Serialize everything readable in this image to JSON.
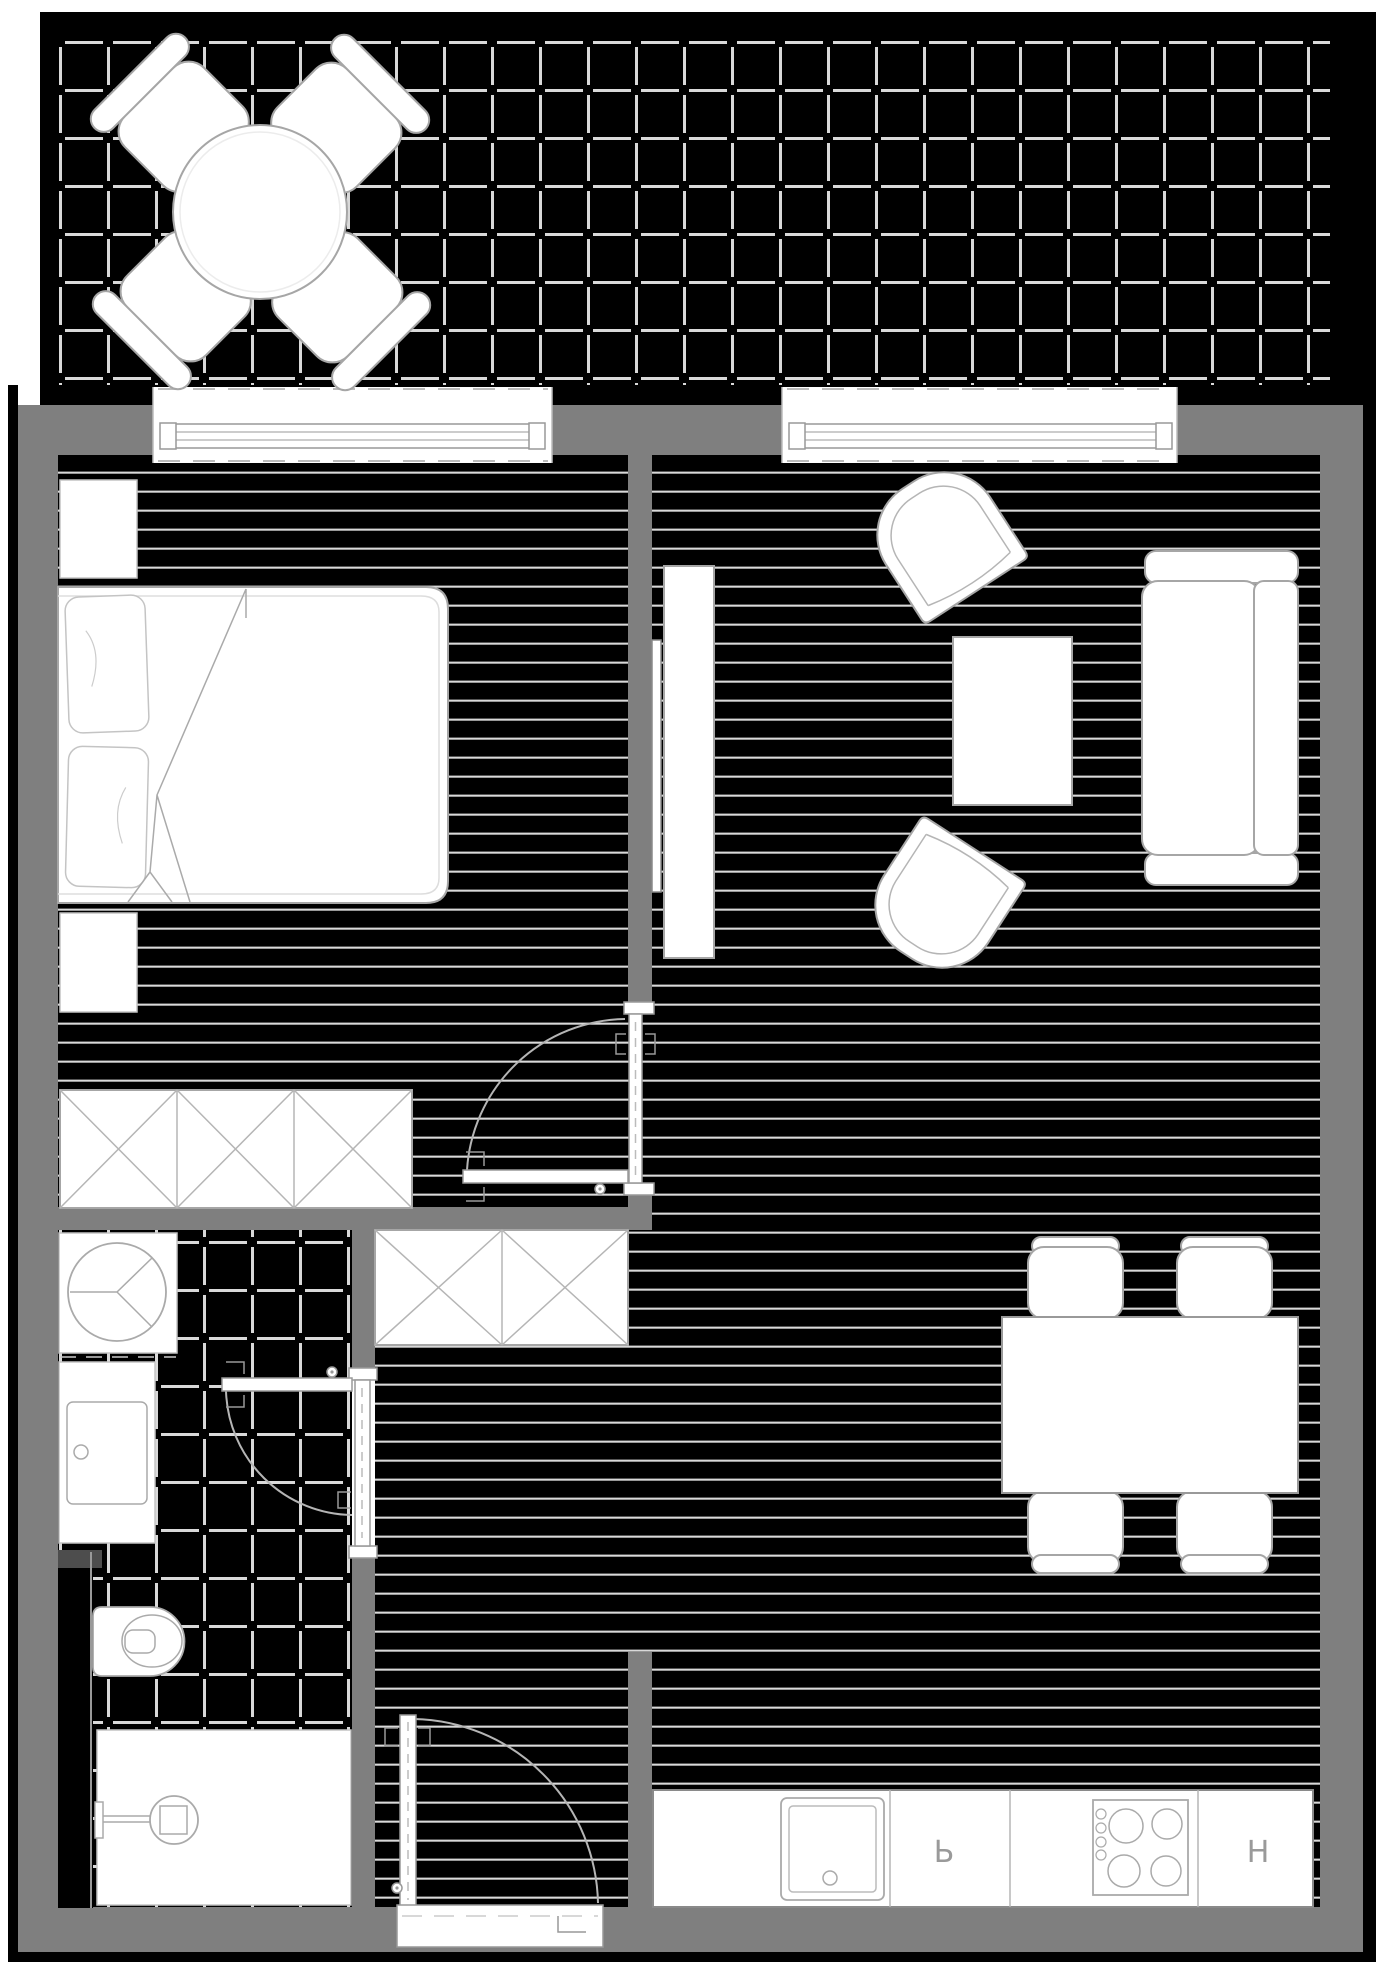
{
  "labels": {
    "counter_mid": "Ь",
    "counter_right": "Н"
  },
  "colors": {
    "wall": "#7f7f7f",
    "balcony_wall": "#000000",
    "floor": "#000000",
    "floor_line": "#d9d9d9",
    "furniture_fill": "#ffffff",
    "furniture_stroke": "#a6a6a6",
    "door_arc": "#b5b5b5",
    "label_text": "#9a9a9a"
  }
}
